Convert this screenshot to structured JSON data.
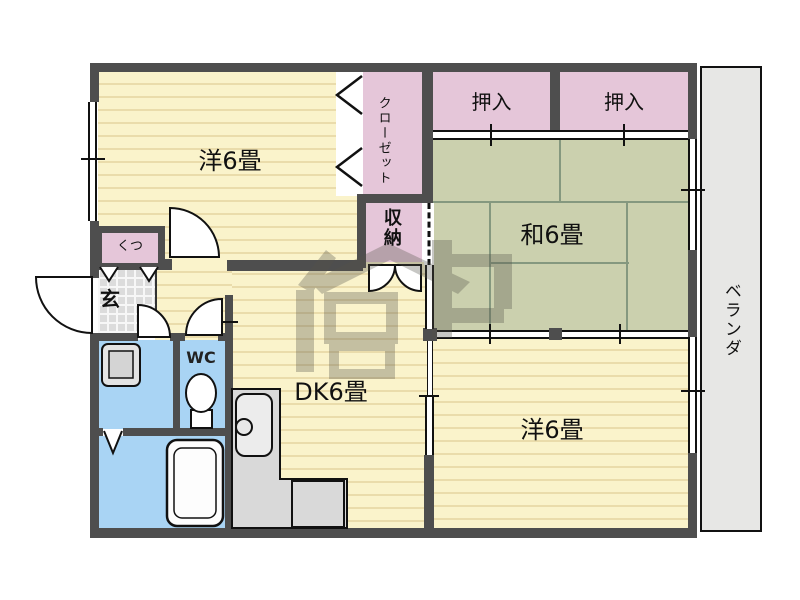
{
  "floorplan": {
    "type": "japanese-apartment-floorplan",
    "rooms": {
      "western_top": {
        "label": "洋6畳"
      },
      "japanese": {
        "label": "和6畳"
      },
      "dining_kitchen": {
        "label": "DK6畳"
      },
      "western_bottom": {
        "label": "洋6畳"
      },
      "closet": {
        "label": "クローゼット"
      },
      "oshiire_left": {
        "label": "押入"
      },
      "oshiire_right": {
        "label": "押入"
      },
      "storage": {
        "label": "収納"
      },
      "veranda": {
        "label": "ベランダ"
      },
      "entrance": {
        "label": "玄"
      },
      "shoe_cabinet": {
        "label": "くつ"
      },
      "toilet": {
        "label": "WC"
      }
    },
    "colors": {
      "wall": "#4e4e4e",
      "wood_floor": "#faf3cb",
      "closet_pink": "#e5c6d9",
      "tatami_green": "#cbd0ae",
      "water_area_blue": "#a9d4f4",
      "veranda_gray": "#e7e7e5",
      "counter_gray": "#d9d9d9"
    },
    "watermark": {
      "description": "semi-transparent realtor logo stamp in center of plan"
    }
  }
}
